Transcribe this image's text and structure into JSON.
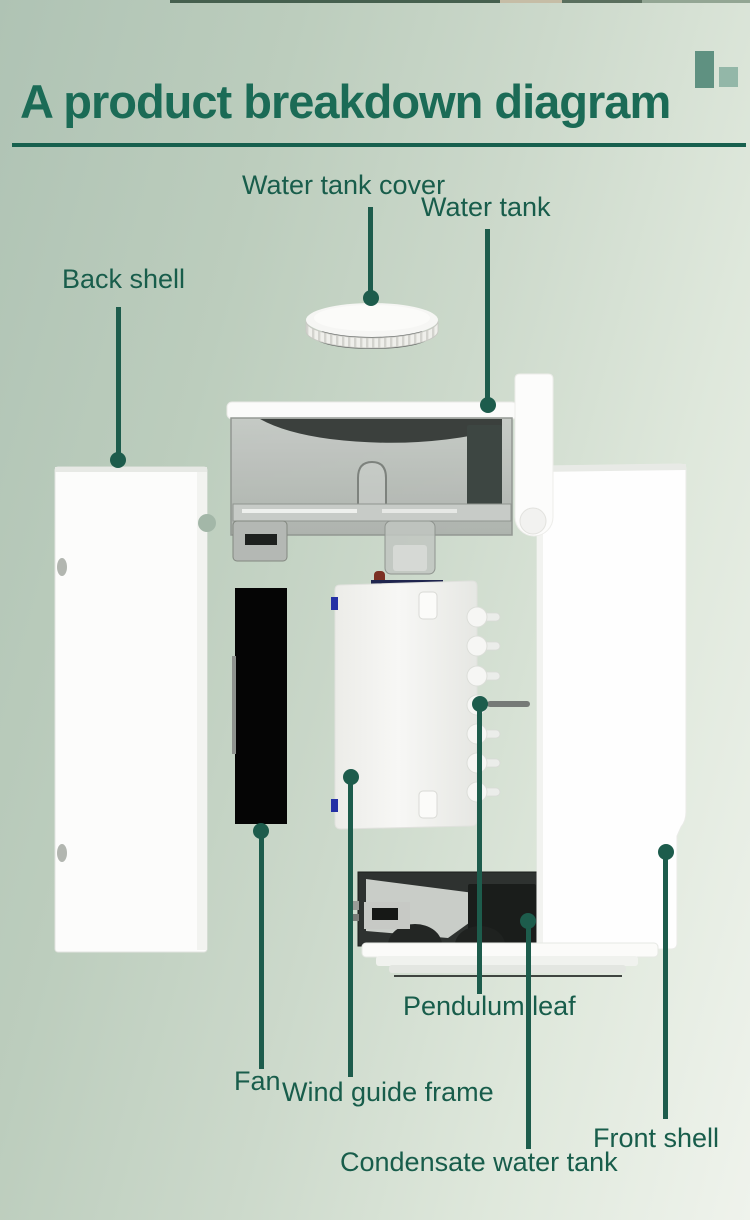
{
  "page": {
    "title": "A product breakdown diagram",
    "title_color": "#1b6b56",
    "underline_color": "#17604e",
    "label_color": "#185d4b",
    "leader_line_color": "#1d5c4c",
    "background_from": "#afc3b4",
    "background_to": "#eff3ec"
  },
  "header_icon": {
    "name": "two-bars-glyph",
    "tall_bar_color": "#5f9181",
    "small_bar_color": "#93b7a8"
  },
  "labels": {
    "water_tank_cover": "Water tank cover",
    "water_tank": "Water tank",
    "back_shell": "Back shell",
    "pendulum_leaf": "Pendulum leaf",
    "fan": "Fan",
    "wind_guide_frame": "Wind guide frame",
    "front_shell": "Front shell",
    "condensate_water_tank": "Condensate water tank"
  }
}
